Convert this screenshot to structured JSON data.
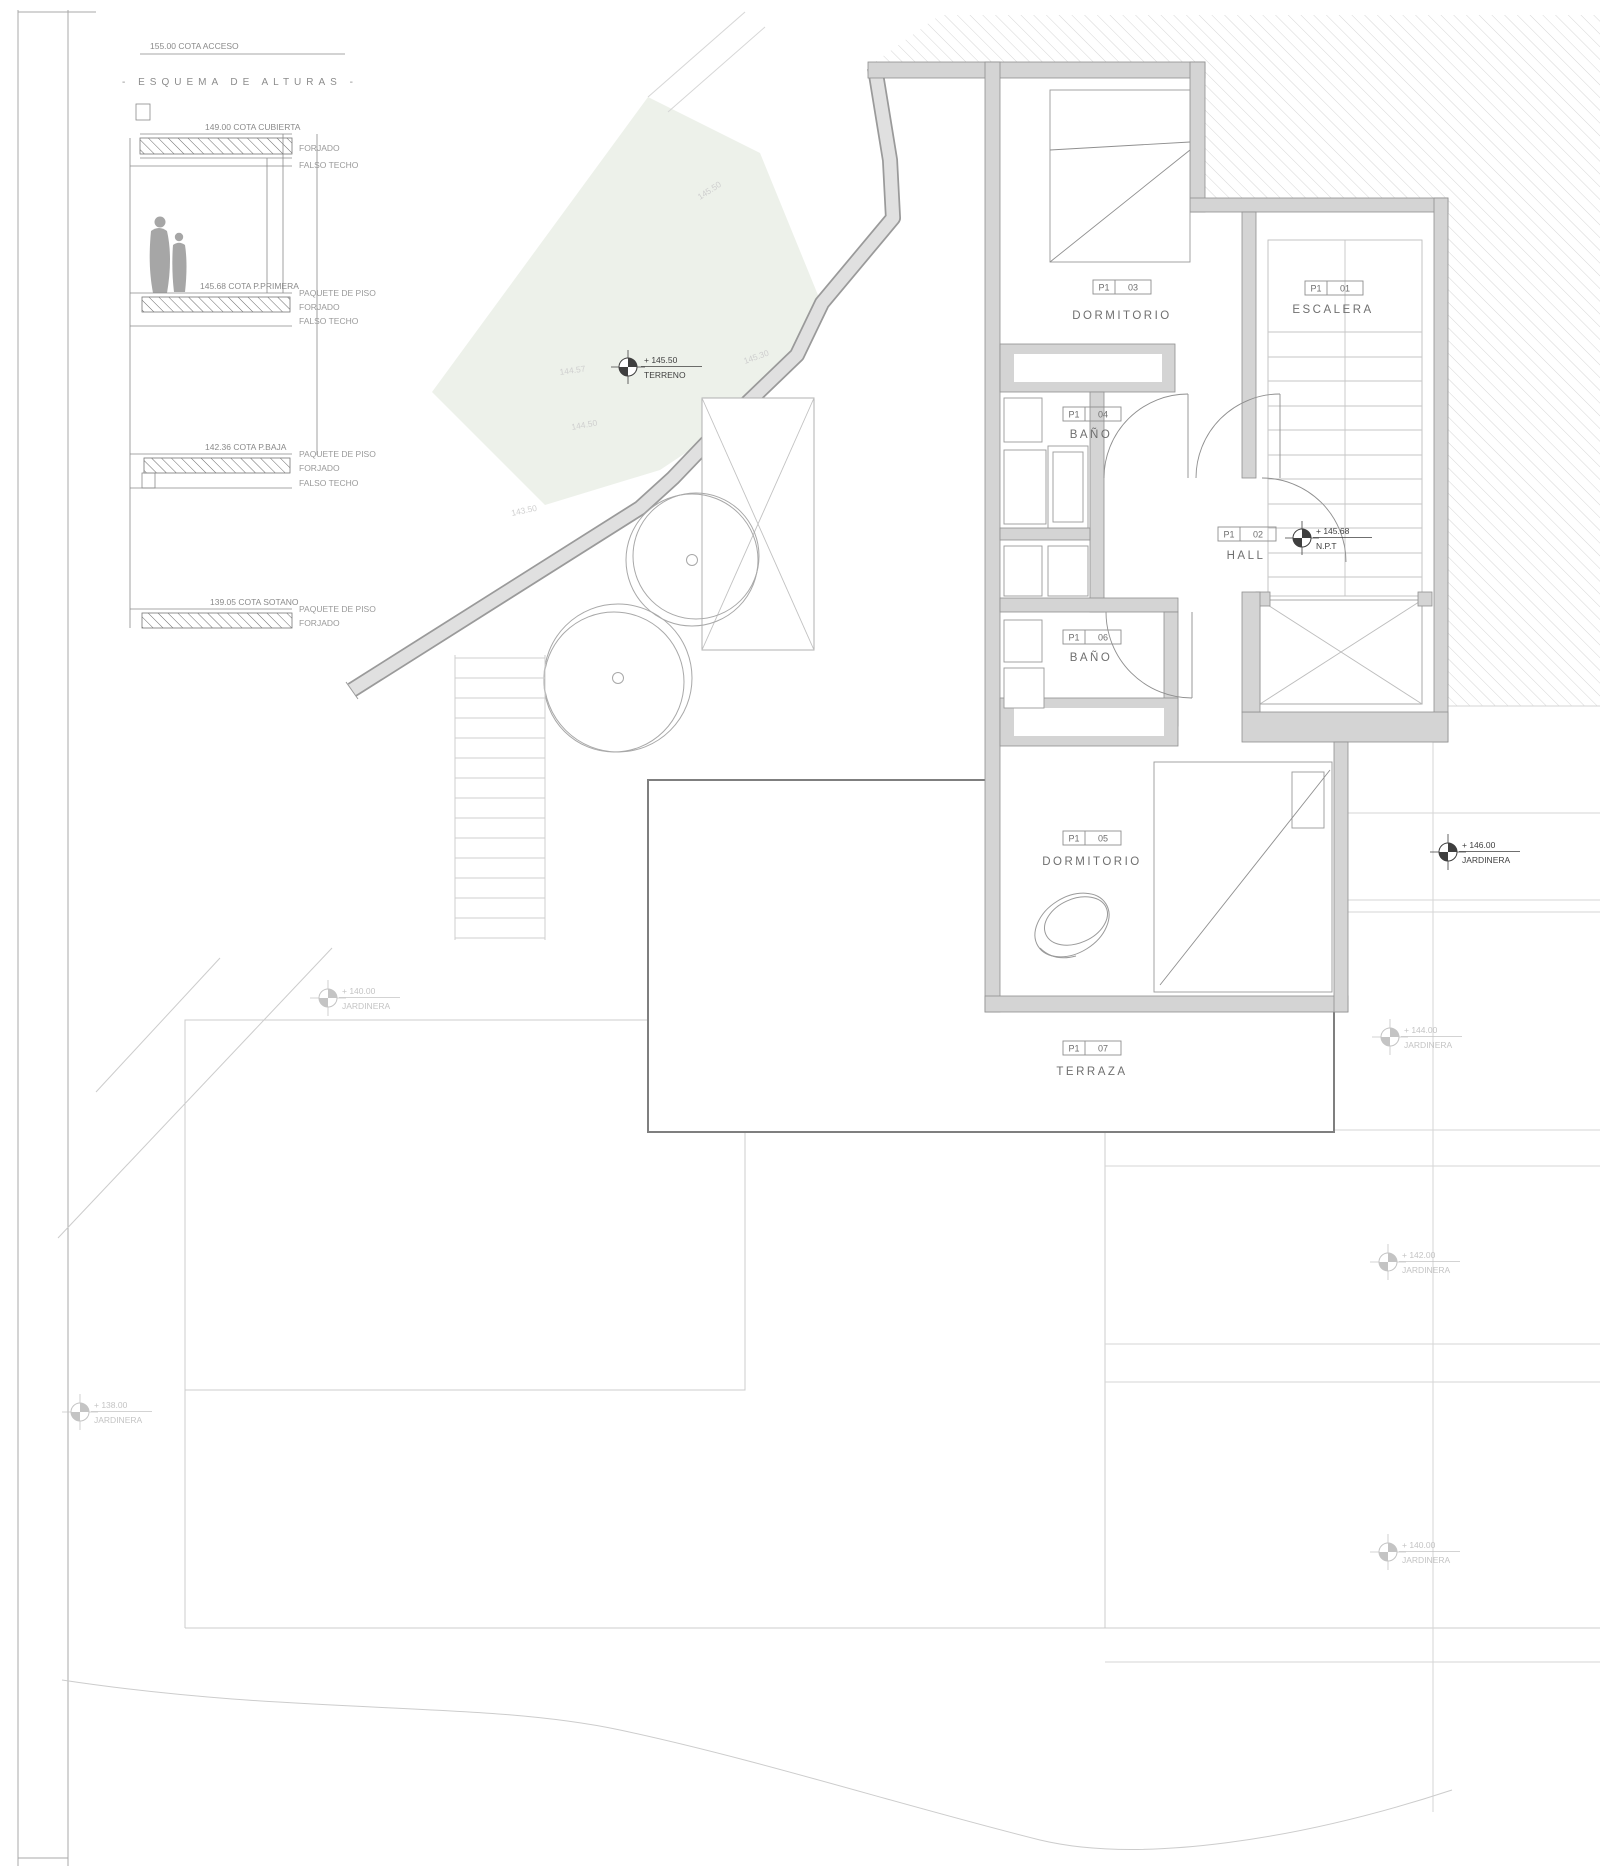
{
  "esquema": {
    "acceso": "155.00 COTA ACCESO",
    "title": "- ESQUEMA DE ALTURAS -",
    "levels": [
      {
        "cota": "149.00 COTA CUBIERTA",
        "l1": "FORJADO",
        "l2": "FALSO TECHO"
      },
      {
        "cota": "145.68 COTA P.PRIMERA",
        "l0": "PAQUETE DE PISO",
        "l1": "FORJADO",
        "l2": "FALSO TECHO"
      },
      {
        "cota": "142.36 COTA P.BAJA",
        "l0": "PAQUETE DE PISO",
        "l1": "FORJADO",
        "l2": "FALSO TECHO"
      },
      {
        "cota": "139.05 COTA SOTANO",
        "l0": "PAQUETE DE PISO",
        "l1": "FORJADO"
      }
    ]
  },
  "rooms": {
    "escalera": {
      "code_l": "P1",
      "code_r": "01",
      "name": "ESCALERA"
    },
    "hall": {
      "code_l": "P1",
      "code_r": "02",
      "name": "HALL"
    },
    "dorm3": {
      "code_l": "P1",
      "code_r": "03",
      "name": "DORMITORIO"
    },
    "bano4": {
      "code_l": "P1",
      "code_r": "04",
      "name": "BAÑO"
    },
    "dorm5": {
      "code_l": "P1",
      "code_r": "05",
      "name": "DORMITORIO"
    },
    "bano6": {
      "code_l": "P1",
      "code_r": "06",
      "name": "BAÑO"
    },
    "terraza": {
      "code_l": "P1",
      "code_r": "07",
      "name": "TERRAZA"
    }
  },
  "markers": {
    "terreno": {
      "value": "+ 145.50",
      "label": "TERRENO"
    },
    "npt": {
      "value": "+ 145.68",
      "label": "N.P.T"
    },
    "jardinera_right": {
      "value": "+ 146.00",
      "label": "JARDINERA"
    },
    "jardinera_r144": {
      "value": "+ 144.00",
      "label": "JARDINERA"
    },
    "jardinera_r142": {
      "value": "+ 142.00",
      "label": "JARDINERA"
    },
    "jardinera_r140": {
      "value": "+ 140.00",
      "label": "JARDINERA"
    },
    "jardinera_left": {
      "value": "+ 140.00",
      "label": "JARDINERA"
    },
    "jardinera_bl": {
      "value": "+ 138.00",
      "label": "JARDINERA"
    }
  },
  "contours": {
    "c1": "145.50",
    "c2": "145.30",
    "c3": "144.57",
    "c4": "144.50",
    "c5": "143.50"
  },
  "colors": {
    "wall_fill": "#d4d4d4",
    "wall_edge": "#8f8f8f",
    "terrain_fill": "#edf1ea",
    "hatch": "#d6d6d6"
  }
}
